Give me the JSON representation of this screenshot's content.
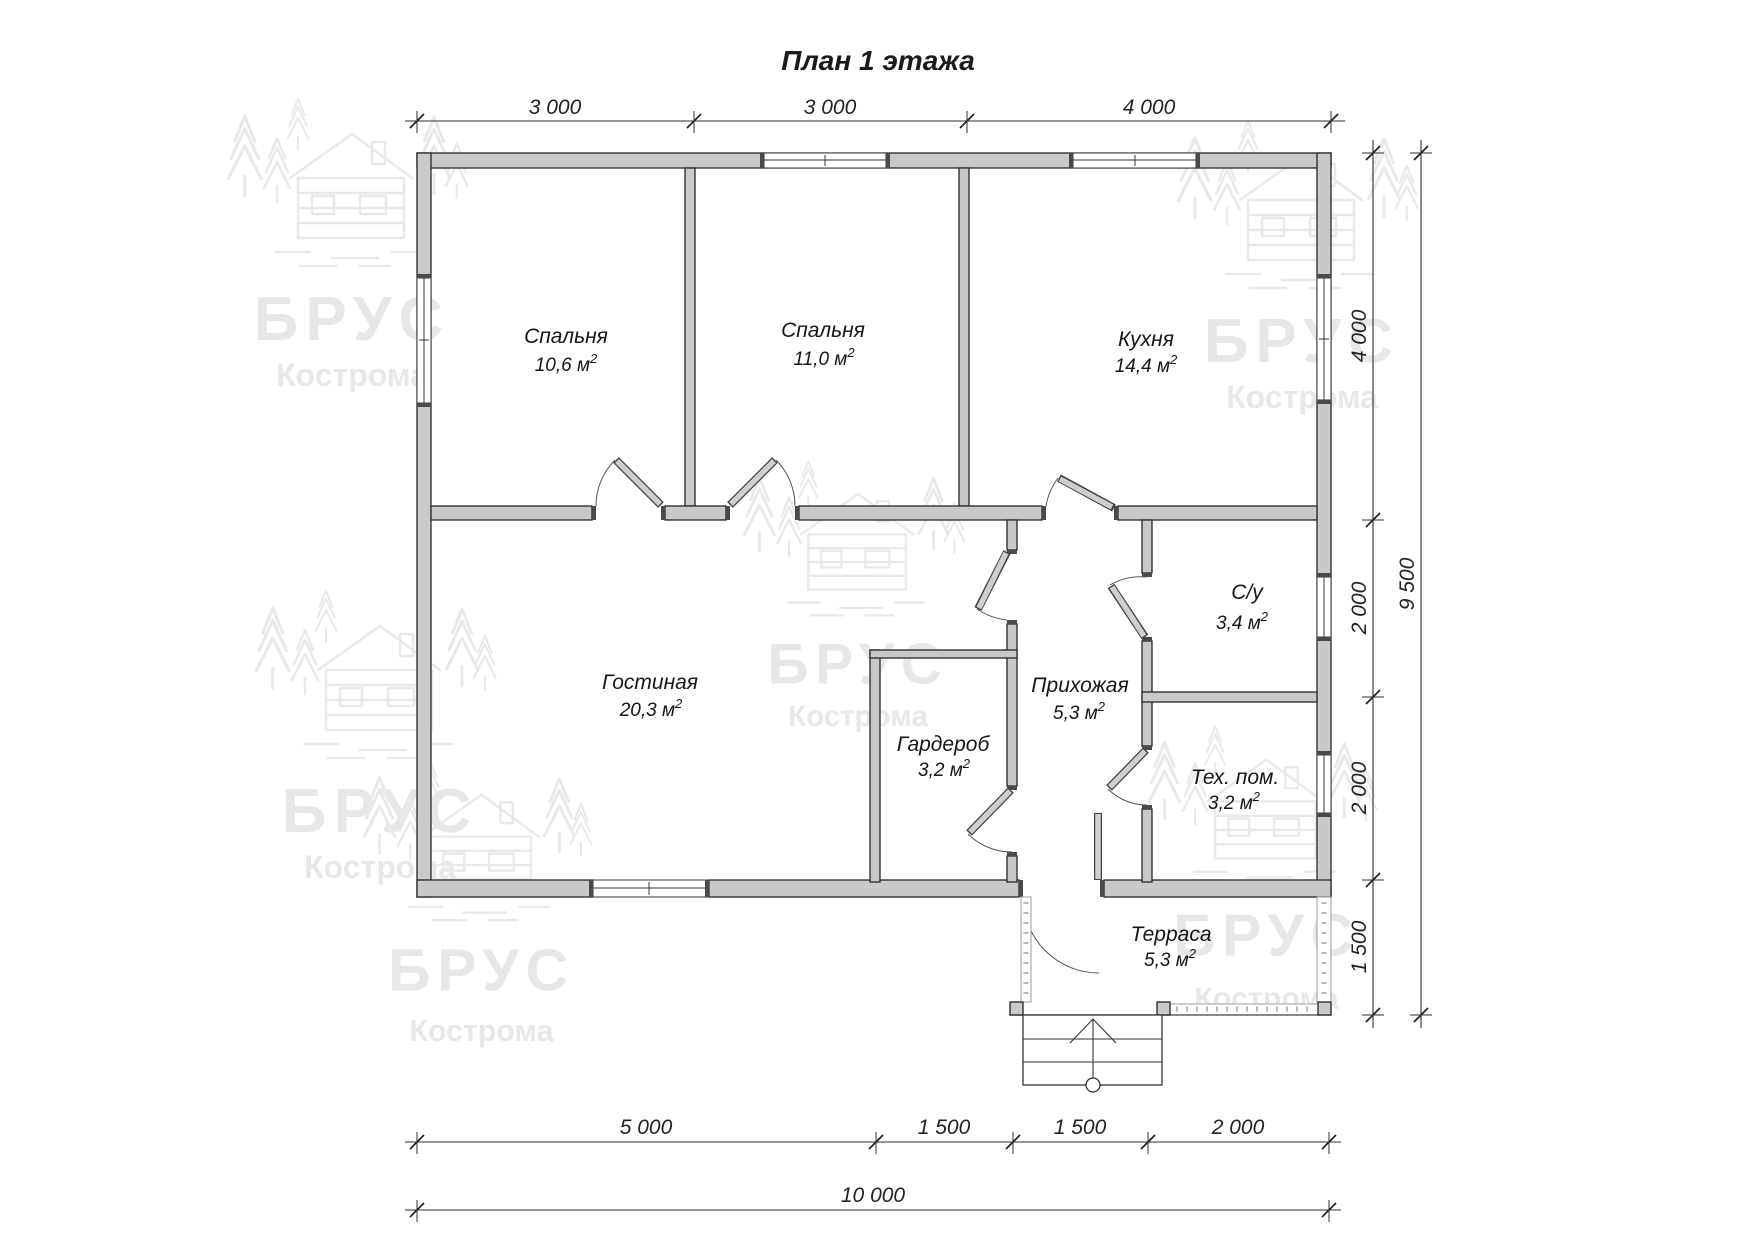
{
  "title": "План 1 этажа",
  "sup": "2",
  "watermark": {
    "brand": "БРУС",
    "city": "Кострома"
  },
  "rooms": [
    {
      "name": "Спальня",
      "area": "10,6 м"
    },
    {
      "name": "Спальня",
      "area": "11,0 м"
    },
    {
      "name": "Кухня",
      "area": "14,4 м"
    },
    {
      "name": "Гостиная",
      "area": "20,3 м"
    },
    {
      "name": "Прихожая",
      "area": "5,3 м"
    },
    {
      "name": "С/у",
      "area": "3,4 м"
    },
    {
      "name": "Гардероб",
      "area": "3,2 м"
    },
    {
      "name": "Тех. пом.",
      "area": "3,2 м"
    },
    {
      "name": "Терраса",
      "area": "5,3 м"
    }
  ],
  "dimensions": {
    "top": [
      "3 000",
      "3 000",
      "4 000"
    ],
    "right": [
      "4 000",
      "2 000",
      "2 000",
      "1 500"
    ],
    "right_total": "9 500",
    "bottom": [
      "5 000",
      "1 500",
      "1 500",
      "2 000"
    ],
    "bottom_total": "10 000"
  }
}
